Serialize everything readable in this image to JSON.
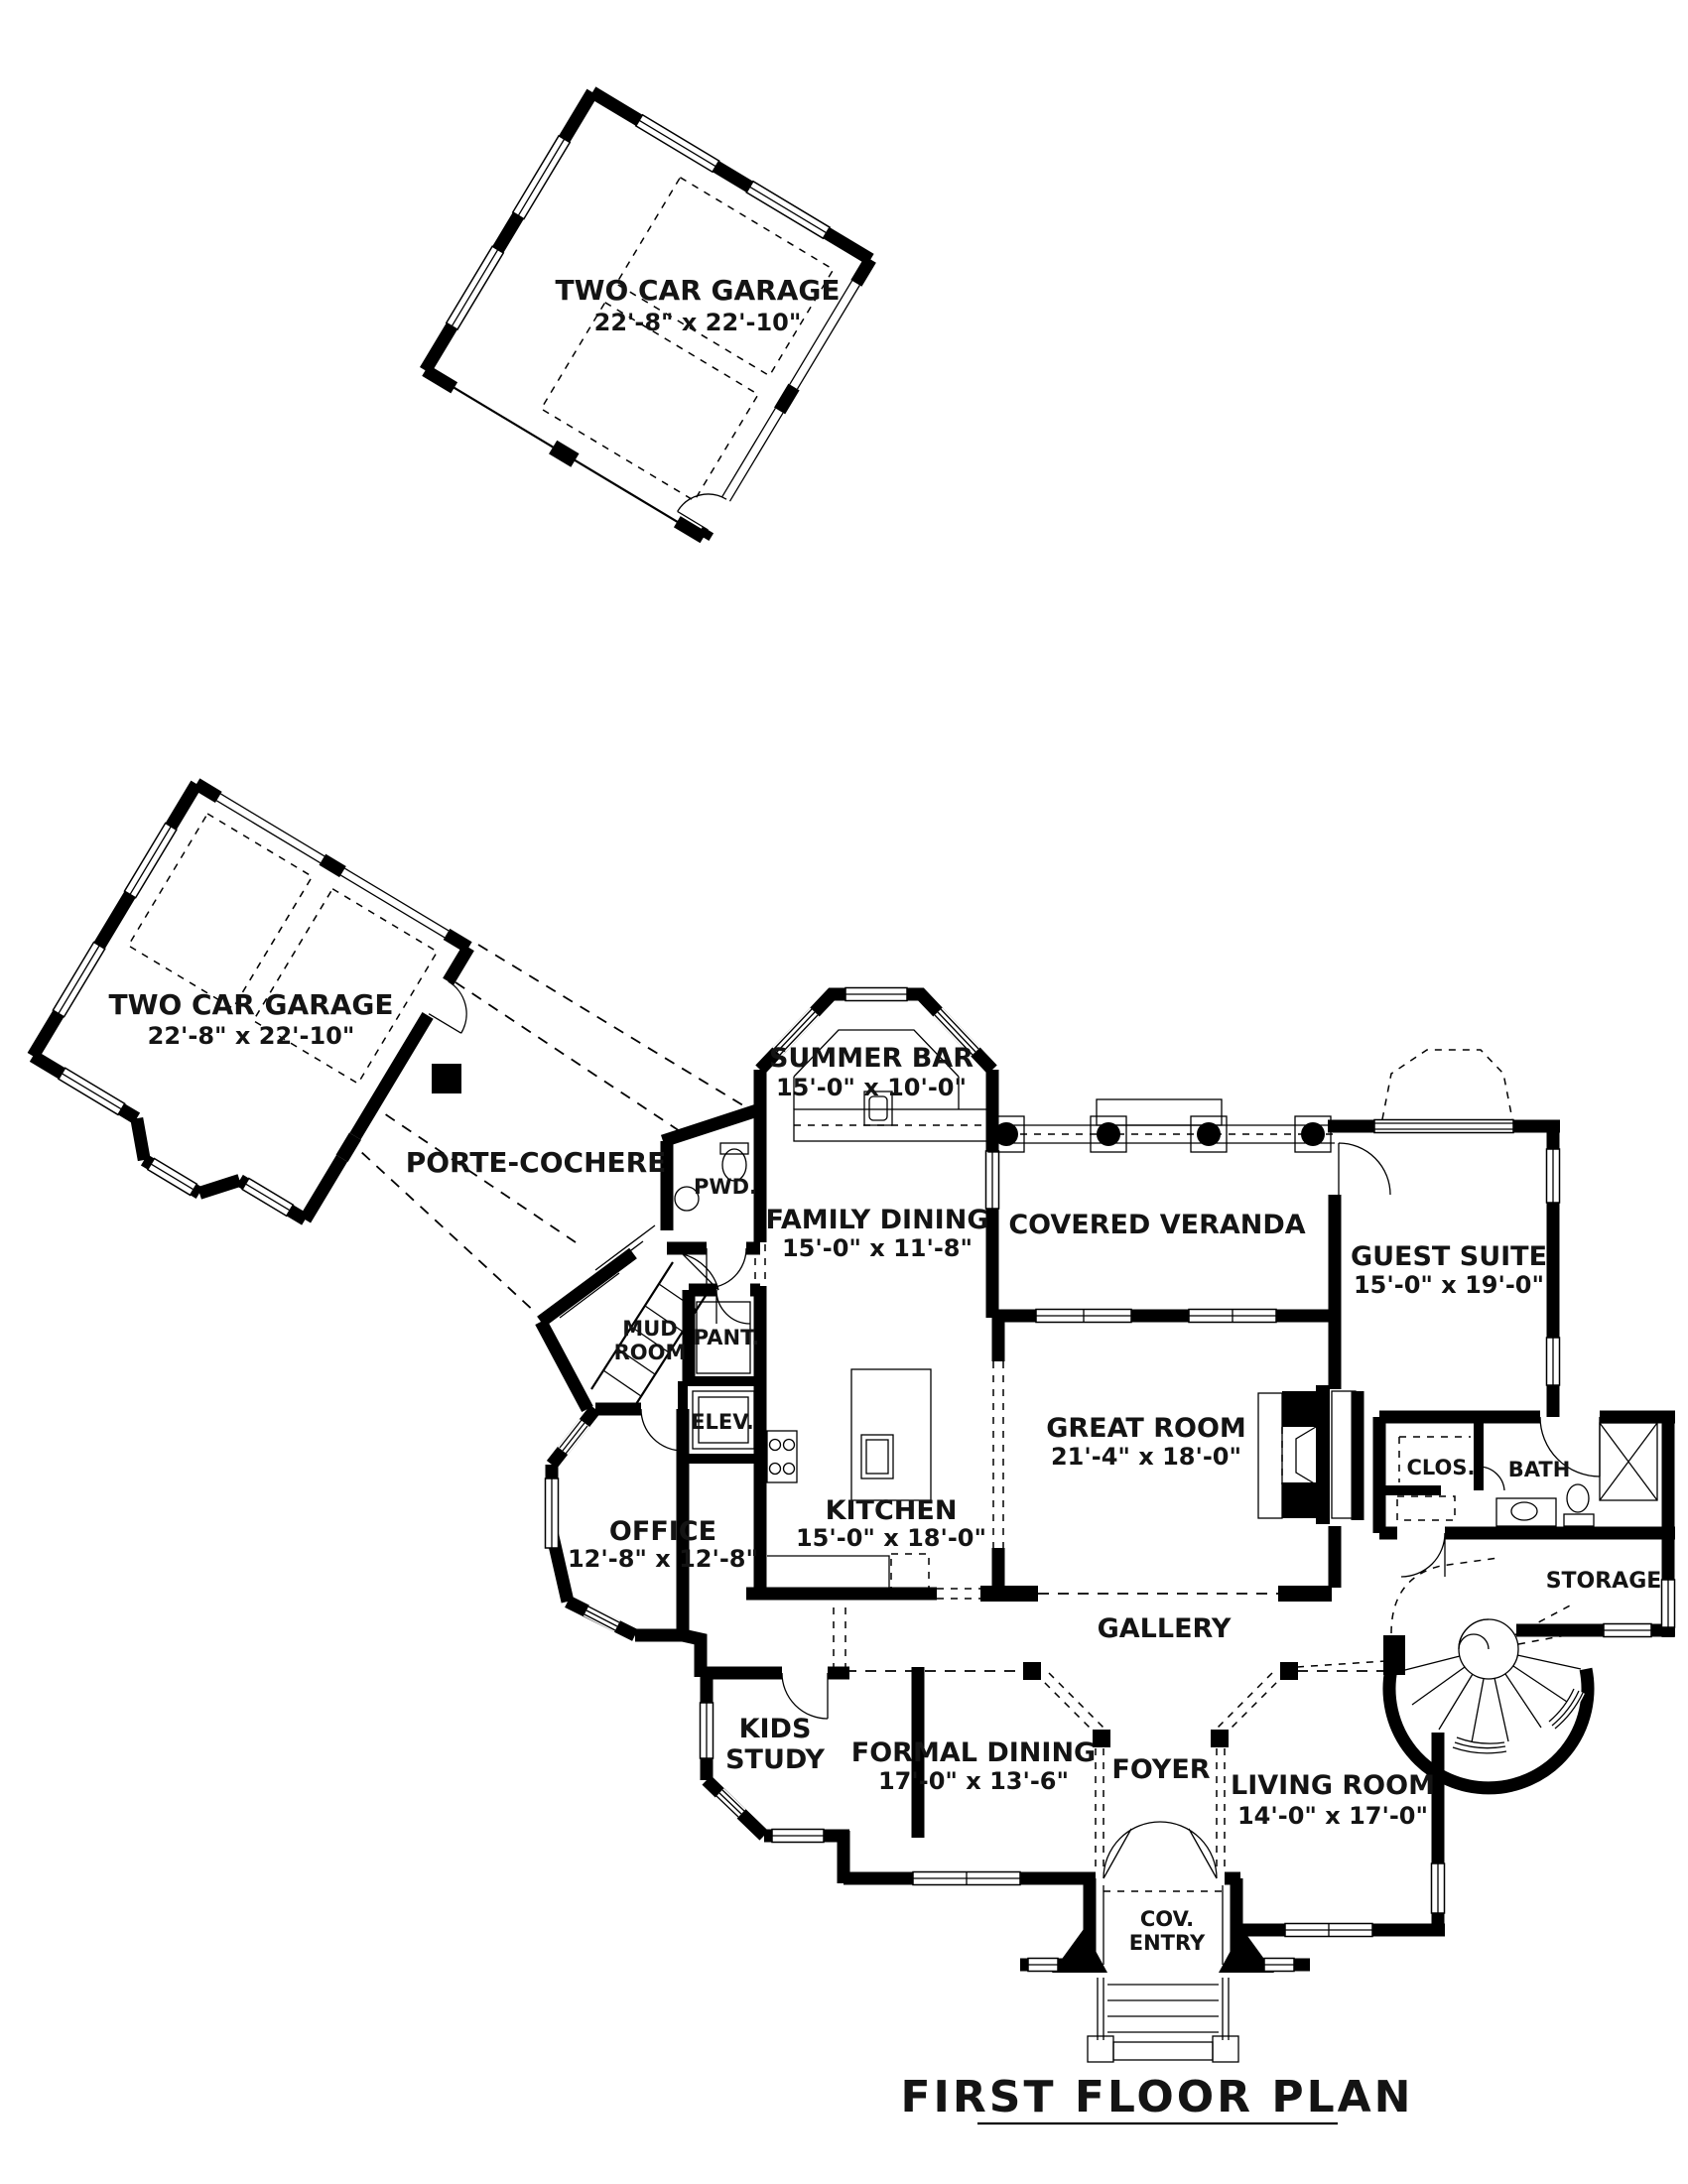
{
  "title": {
    "text": "FIRST FLOOR PLAN"
  },
  "rooms": {
    "garage_top": {
      "name": "TWO CAR GARAGE",
      "dims": "22'-8\" x 22'-10\""
    },
    "garage_left": {
      "name": "TWO CAR GARAGE",
      "dims": "22'-8\" x 22'-10\""
    },
    "porte_cochere": {
      "name": "PORTE-COCHERE"
    },
    "summer_bar": {
      "name": "SUMMER BAR",
      "dims": "15'-0\" x 10'-0\""
    },
    "family_dining": {
      "name": "FAMILY DINING",
      "dims": "15'-0\" x 11'-8\""
    },
    "covered_veranda": {
      "name": "COVERED VERANDA"
    },
    "guest_suite": {
      "name": "GUEST SUITE",
      "dims": "15'-0\" x 19'-0\""
    },
    "great_room": {
      "name": "GREAT ROOM",
      "dims": "21'-4\" x 18'-0\""
    },
    "kitchen": {
      "name": "KITCHEN",
      "dims": "15'-0\" x 18'-0\""
    },
    "office": {
      "name": "OFFICE",
      "dims": "12'-8\" x 12'-8\""
    },
    "mud_room": {
      "line1": "MUD",
      "line2": "ROOM"
    },
    "pantry": {
      "name": "PANT."
    },
    "elevator": {
      "name": "ELEV."
    },
    "powder": {
      "name": "PWD."
    },
    "closet": {
      "name": "CLOS."
    },
    "bath": {
      "name": "BATH"
    },
    "storage": {
      "name": "STORAGE"
    },
    "gallery": {
      "name": "GALLERY"
    },
    "kids_study": {
      "line1": "KIDS",
      "line2": "STUDY"
    },
    "formal_dining": {
      "name": "FORMAL DINING",
      "dims": "17'-0\" x 13'-6\""
    },
    "foyer": {
      "name": "FOYER"
    },
    "living_room": {
      "name": "LIVING ROOM",
      "dims": "14'-0\" x 17'-0\""
    },
    "covered_entry": {
      "line1": "COV.",
      "line2": "ENTRY"
    }
  }
}
